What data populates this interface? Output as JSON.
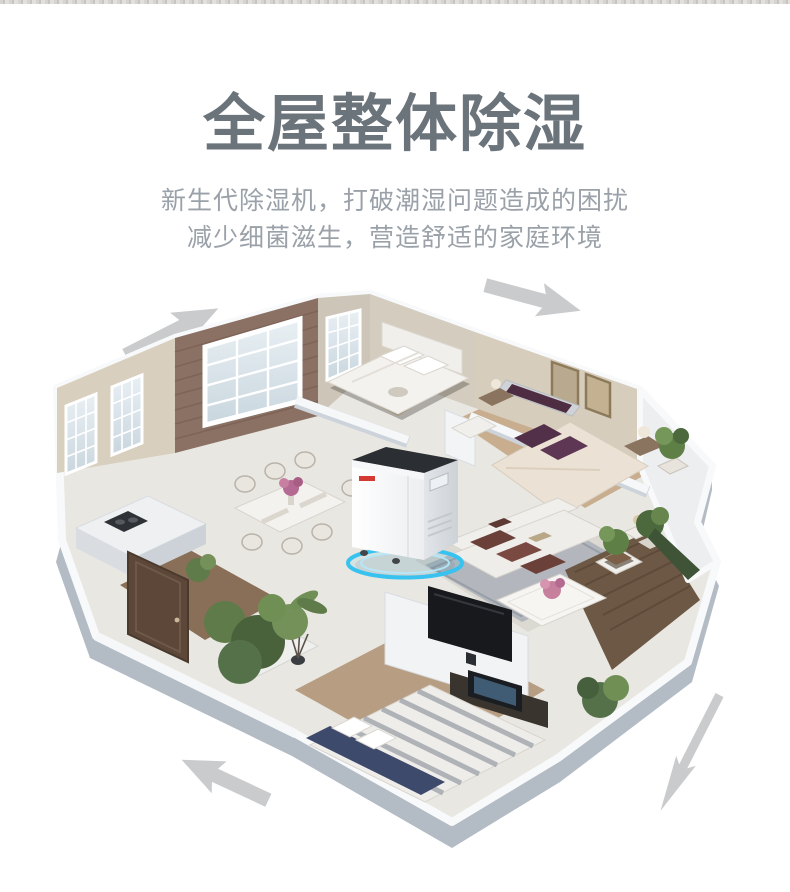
{
  "header": {
    "title": "全屋整体除湿",
    "subtitle_line1": "新生代除湿机，打破潮湿问题造成的困扰",
    "subtitle_line2": "减少细菌滋生，营造舒适的家庭环境",
    "title_color": "#6b737b",
    "subtitle_color": "#9aa1a8"
  },
  "illustration": {
    "type": "isometric-cutaway-apartment-3d-render",
    "arrow_color": "#c9cbcd",
    "airflow_arrows": [
      {
        "position": "top-left",
        "direction": "up-right"
      },
      {
        "position": "top-right",
        "direction": "down-right"
      },
      {
        "position": "bottom-left",
        "direction": "up-left"
      },
      {
        "position": "bottom-right",
        "direction": "down-left"
      }
    ],
    "rooms": [
      "top-bedroom",
      "master-bedroom",
      "living-room",
      "dining-area",
      "kitchen",
      "entry-hall",
      "bottom-bedroom",
      "right-balcony",
      "bay-balcony"
    ],
    "product": {
      "name": "dehumidifier",
      "body_color": "#fbfbfc",
      "top_color": "#2b2e33",
      "logo_color": "#d43a31",
      "glow_color": "#38c2f0"
    },
    "palette": {
      "exterior_wall": "#b3bbc5",
      "wall_cap": "#f8f9fa",
      "brick_wall": "#8a7163",
      "beige_wall": "#d8cfbe",
      "wood_floor": "#c8ae8f",
      "dark_wood_floor": "#6d5745",
      "tile_floor": "#e9e7e2",
      "rug": "#b3b7bd",
      "plant_green": "#5e7b49",
      "cushion_red": "#6b4038",
      "headboard_purple": "#4e2c41",
      "bed_navy": "#3d4a6b"
    }
  }
}
